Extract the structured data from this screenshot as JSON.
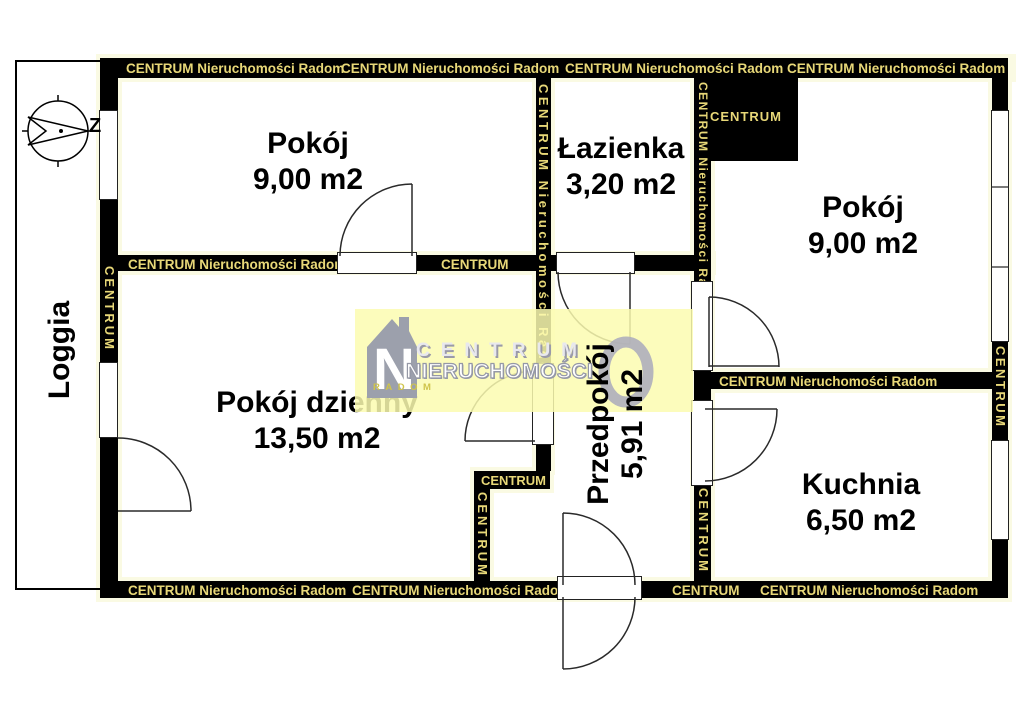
{
  "plan": {
    "compass_letter": "Z",
    "watermark_full": "CENTRUM Nieruchomości Radom",
    "watermark_short": "CENTRUM",
    "colors": {
      "wall": "#000000",
      "wall_text": "#E8D878",
      "halo": "#FAFAE3",
      "logo_band": "#FCFCB0",
      "logo_gray": "#9CA0AC",
      "logo_city_text": "#CFC44A"
    }
  },
  "rooms": {
    "pokoj1": {
      "name": "Pokój",
      "area": "9,00 m2"
    },
    "lazienka": {
      "name": "Łazienka",
      "area": "3,20 m2"
    },
    "pokoj2": {
      "name": "Pokój",
      "area": "9,00 m2"
    },
    "pokoj_dzienny": {
      "name": "Pokój dzienny",
      "area": "13,50 m2"
    },
    "przedpokoj": {
      "name": "Przedpokój",
      "area": "5,91 m2"
    },
    "kuchnia": {
      "name": "Kuchnia",
      "area": "6,50 m2"
    },
    "loggia": {
      "name": "Loggia"
    }
  },
  "logo": {
    "brand": "CENTRUM",
    "brand2": "NIERUCHOMOŚCI",
    "city": "RADOM",
    "monogram": "N"
  }
}
